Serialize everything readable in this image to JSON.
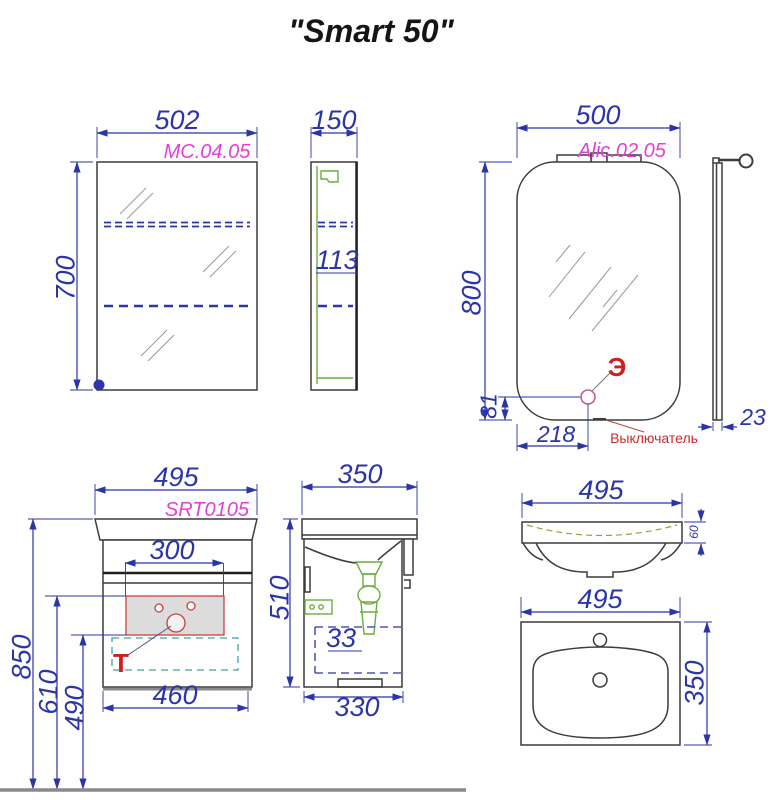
{
  "title": "\"Smart 50\"",
  "colors": {
    "dimension_blue": "#2b35a8",
    "code_magenta": "#e23fd7",
    "annotation_red": "#cc1f1f",
    "hardware_green": "#6aad3d",
    "drawer_teal": "#3aa8a0",
    "switch_pink": "#c75b8f",
    "outline_dark": "#3c3c3c",
    "floor_gray": "#8a8a8a",
    "cutout_fill": "#dcdcdc",
    "cutout_stroke": "#cc4040",
    "basin_olive": "#93a03a"
  },
  "labels": {
    "mc_front": {
      "width": "502",
      "height": "700",
      "code": "MC.04.05"
    },
    "mc_side": {
      "depth": "150",
      "shelf": "113"
    },
    "mirror": {
      "width": "500",
      "height": "800",
      "code": "Alic.02.05",
      "electric_mark": "Э",
      "switch_offset_x": "218",
      "switch_offset_y": "81",
      "switch_label": "Выключатель"
    },
    "mirror_side": {
      "thickness": "23"
    },
    "vanity_front": {
      "width": "495",
      "code": "SRT0105",
      "cutout_width": "300",
      "body_width": "460",
      "height_total": "850",
      "height_cutout_top": "610",
      "height_cutout_bottom": "490",
      "trap_mark": "Т"
    },
    "vanity_side": {
      "depth": "350",
      "height": "510",
      "inset": "33",
      "body_depth": "330"
    },
    "sink_front": {
      "width": "495",
      "rim_height": "60"
    },
    "sink_top": {
      "width": "495",
      "depth": "350"
    }
  }
}
